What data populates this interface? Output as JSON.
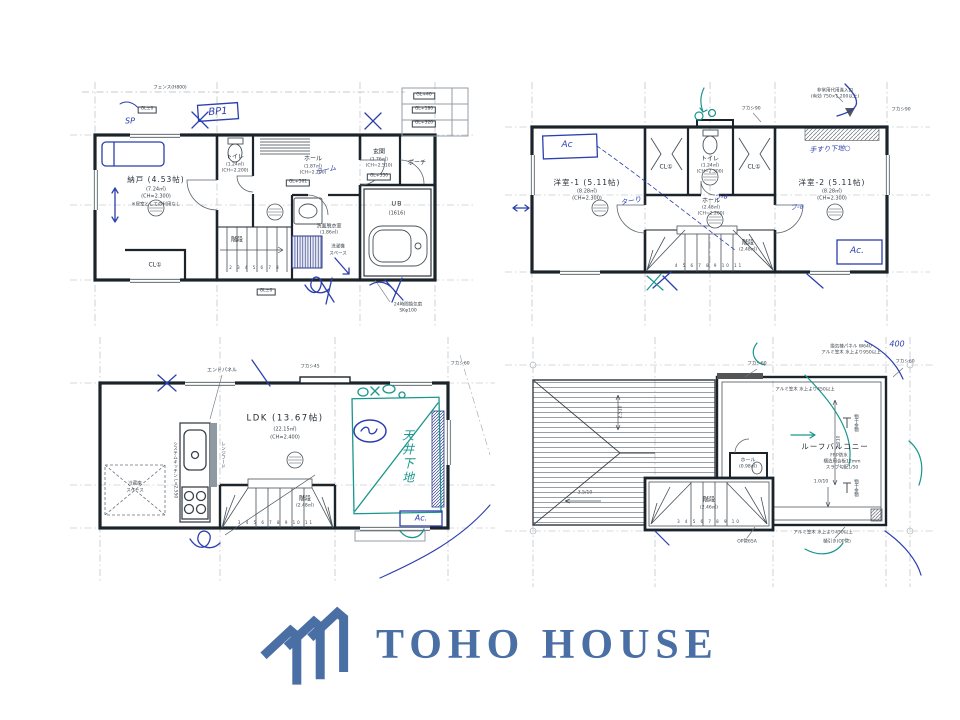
{
  "colors": {
    "logo_blue": "#4a6fa5",
    "pen_blue": "#2b3fae",
    "pen_green": "#19968c"
  },
  "logo": {
    "text": "TOHO HOUSE"
  },
  "f1": {
    "rooms": {
      "nando1": "納戸 (4.53帖)",
      "nando2": "(7.24㎡)",
      "nando3": "(CH=2.300)",
      "nando4": "※居室としての利用なし",
      "cl": "CL①",
      "toilet1": "トイレ",
      "toilet2": "(1.24㎡)",
      "toilet3": "(CH=2.200)",
      "hall1": "ホール",
      "hall2": "(1.87㎡)",
      "hall3": "(CH=2.200)",
      "genkan1": "玄関",
      "genkan2": "(1.76㎡)",
      "genkan3": "(CH=2.510)",
      "porch": "ポーチ",
      "ub1": "UB",
      "ub2": "(1616)",
      "senmen1": "洗面脱衣室",
      "senmen2": "(1.86㎡)",
      "laundry1": "洗濯機",
      "laundry2": "スペース",
      "stairs": "階段",
      "stair_nums": "2 3 4 5 6 7 8"
    },
    "levels": {
      "gl0_top": "GL±0",
      "gl0_btm": "GL±0",
      "gl40": "GL+40",
      "gl180": "GL+180",
      "gl320": "GL+320",
      "gl350": "GL+350",
      "gl561": "GL+561"
    },
    "notes": {
      "fence": "フェンス(H800)",
      "vent1": "24時間換気扇",
      "vent2": "SKφ100"
    },
    "hand": {
      "sp": "SP",
      "bp1": "BP1",
      "memo": "ラーム"
    }
  },
  "f2": {
    "rooms": {
      "w1a": "洋室-1 (5.11帖)",
      "w1b": "(8.28㎡)",
      "w1c": "(CH=2.300)",
      "w2a": "洋室-2 (5.11帖)",
      "w2b": "(8.28㎡)",
      "w2c": "(CH=2.300)",
      "cl1": "CL①",
      "cl2": "CL①",
      "toilet1": "トイレ",
      "toilet2": "(1.24㎡)",
      "toilet3": "(CH=2.300)",
      "hall1": "ホール",
      "hall2": "(2.48㎡)",
      "hall3": "(CH=2.200)",
      "stairs1": "階段",
      "stairs2": "(2.48㎡)",
      "stair_nums": "4 5 6 7 8 9 10 11"
    },
    "notes": {
      "emg1": "非常用代用進入口",
      "emg2": "(有効 750×1,200以上)",
      "fukashi_l": "フカシ90",
      "fukashi_r": "フカシ90"
    },
    "hand": {
      "ac1": "Ac",
      "ac2": "Ac.",
      "rail": "手すり下地○",
      "d1": "ターり",
      "d2": "フ-a",
      "d3": "フ-a"
    }
  },
  "f3": {
    "rooms": {
      "ldk1": "LDK (13.67帖)",
      "ldk2": "(22.15㎡)",
      "ldk3": "(CH=2.400)",
      "fridge1": "冷蔵庫",
      "fridge2": "スペース",
      "stairs1": "階段",
      "stairs2": "(2.48㎡)",
      "stair_nums": "3 4 5 6 7 8 9 10 11"
    },
    "notes": {
      "endpanel": "エンドパネル",
      "fukashi45": "フカシ45",
      "fukashi60": "フカシ60",
      "kitchen": "システムキッチン L=2,550",
      "hood": "レンジフード"
    },
    "hand": {
      "ceiling": "天井下地",
      "ac": "Ac."
    }
  },
  "f4": {
    "labels": {
      "balcony": "ルーフバルコニー",
      "frp": "FRP防水",
      "board": "構造用合板12mm",
      "slope": "スラブ勾配1/50",
      "stairs1": "階段",
      "stairs2": "(2.46㎡)",
      "stair_nums": "3 4 5 6 7 8 9 10",
      "hall1": "ホール",
      "hall2": "(0.98㎡)",
      "kasagi950a": "換気棟パネル W640",
      "kasagi950b": "アルミ笠木 水上より950以上",
      "kasagi450t": "アルミ笠木 水上より450以上",
      "kasagi450b": "アルミ笠木 水上より450以上",
      "fukashi_l": "フカシ60",
      "fukashi_r": "フカシ60",
      "slope_l": "3.5/10",
      "slope_d": "1.0/10",
      "dim_v": "2,210",
      "dim_roof": "2,510",
      "pipe1": "OP管65A",
      "pipe2": "樋引き(OP管)",
      "monohoshi1": "物干金物",
      "monohoshi2": "物干金物"
    },
    "hand": {
      "d400": "400"
    }
  }
}
